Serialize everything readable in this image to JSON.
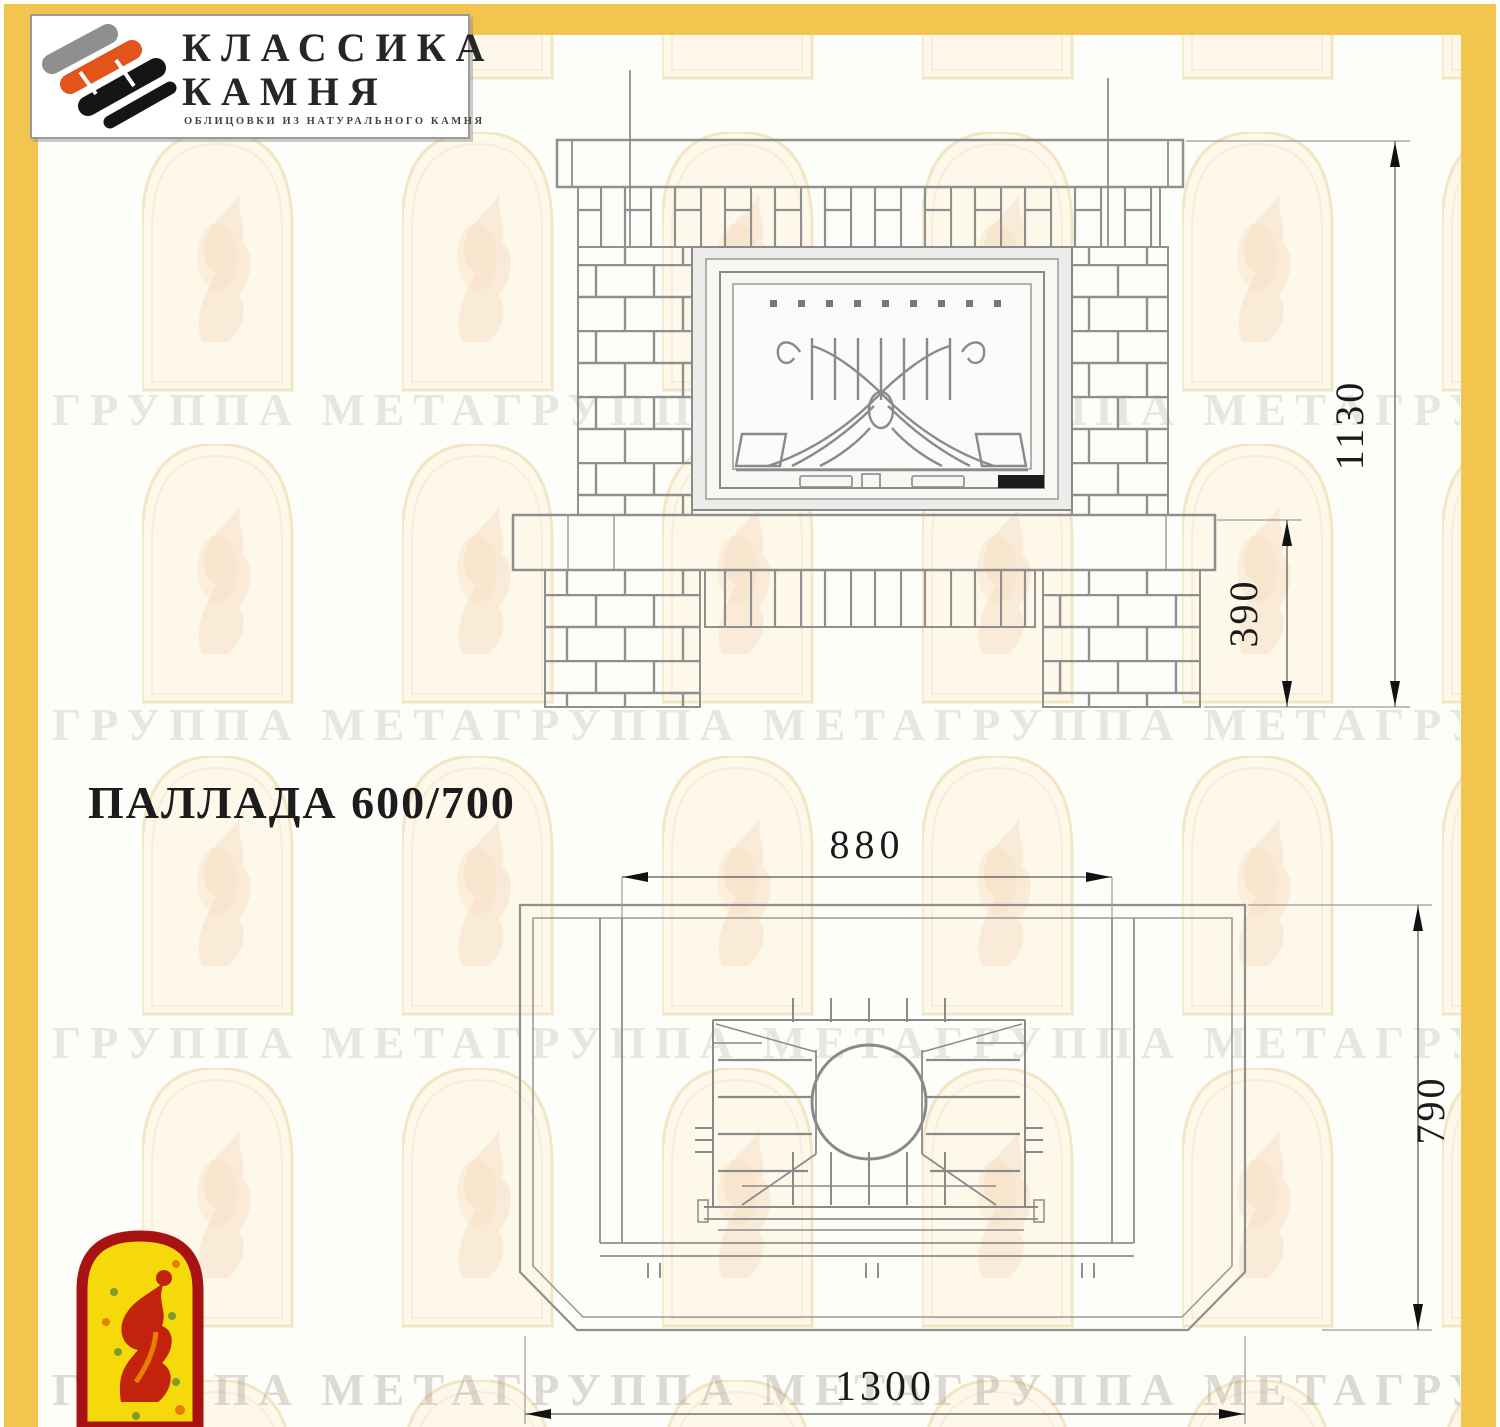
{
  "frame": {
    "color": "#F2C54F"
  },
  "logo": {
    "company_line1": "КЛАССИКА",
    "company_line2": "КАМНЯ",
    "tagline": "ОБЛИЦОВКИ ИЗ НАТУРАЛЬНОГО КАМНЯ"
  },
  "title": "ПАЛЛАДА 600/700",
  "front_view": {
    "dim_total_height": "1130",
    "dim_hearth_height": "390"
  },
  "plan_view": {
    "dim_portal_width": "880",
    "dim_depth": "790",
    "dim_total_width": "1300"
  },
  "watermark": {
    "row_text": "ГРУППА МЕТАГРУППА МЕТАГРУППА МЕТАГРУППА МЕТА"
  }
}
